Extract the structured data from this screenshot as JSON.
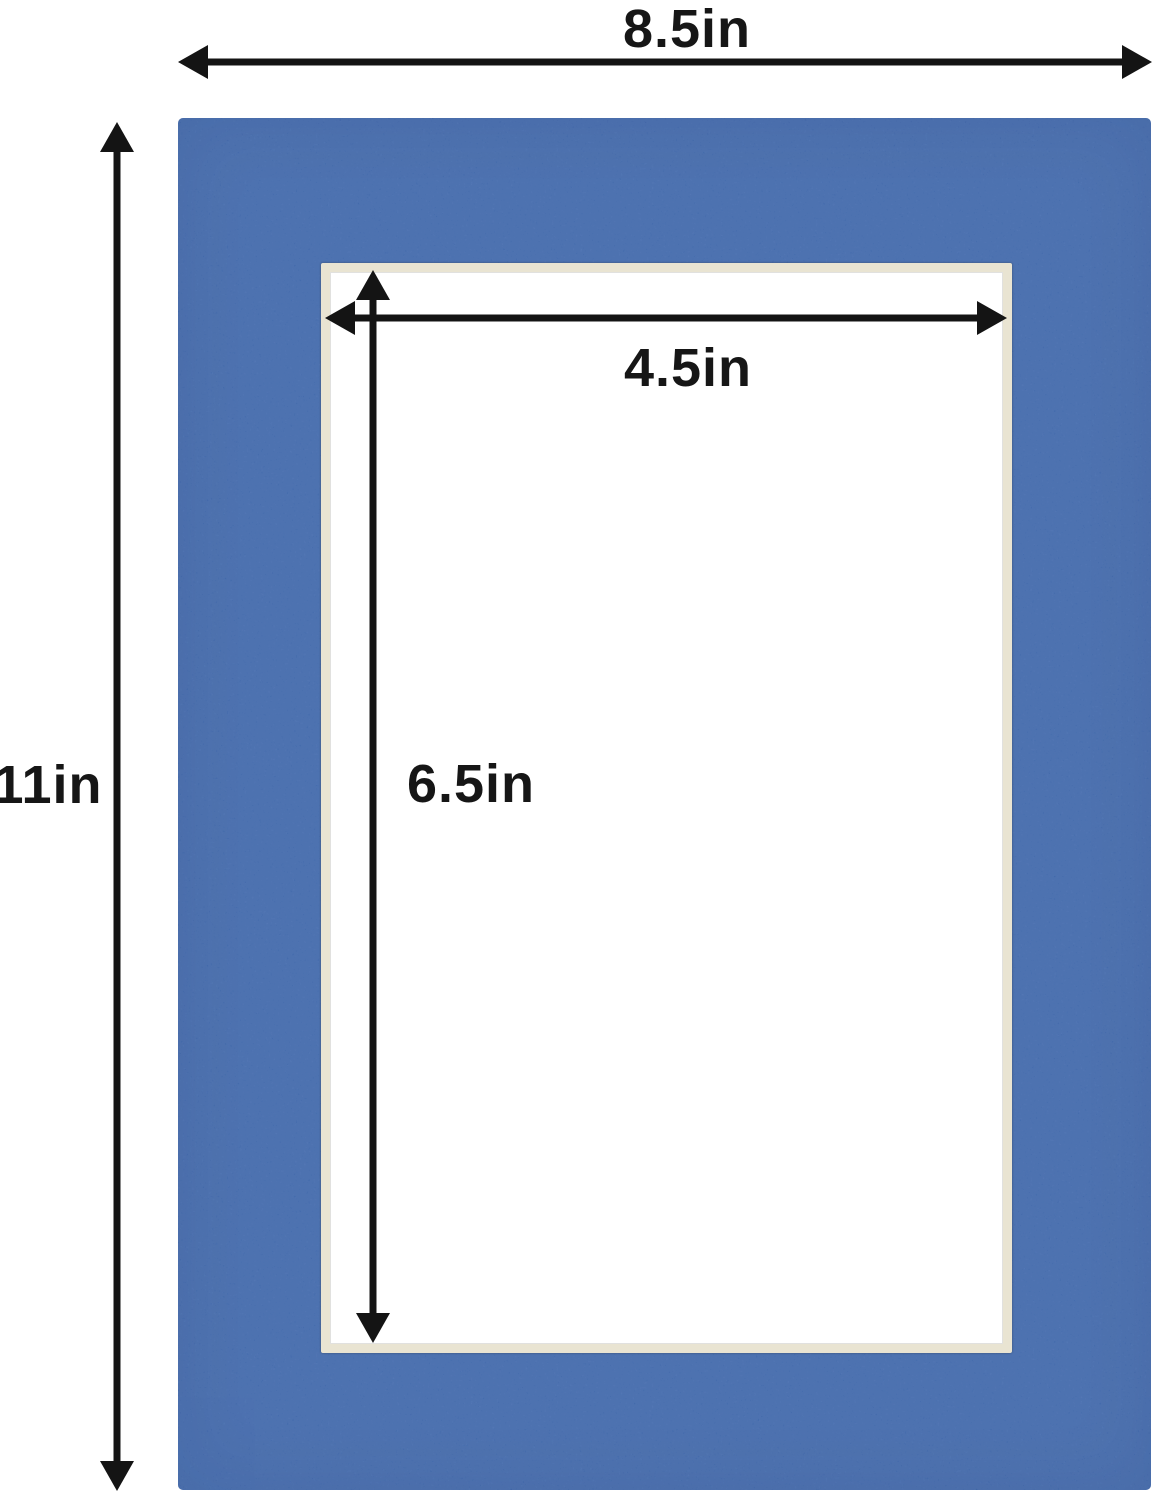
{
  "diagram": {
    "outer": {
      "width_label": "8.5in",
      "height_label": "11in"
    },
    "opening": {
      "width_label": "4.5in",
      "height_label": "6.5in"
    },
    "colors": {
      "background": "#ffffff",
      "mat-blue": "#3d68af",
      "bevel-cream": "#e9e4d2",
      "arrow-black": "#141414"
    }
  }
}
